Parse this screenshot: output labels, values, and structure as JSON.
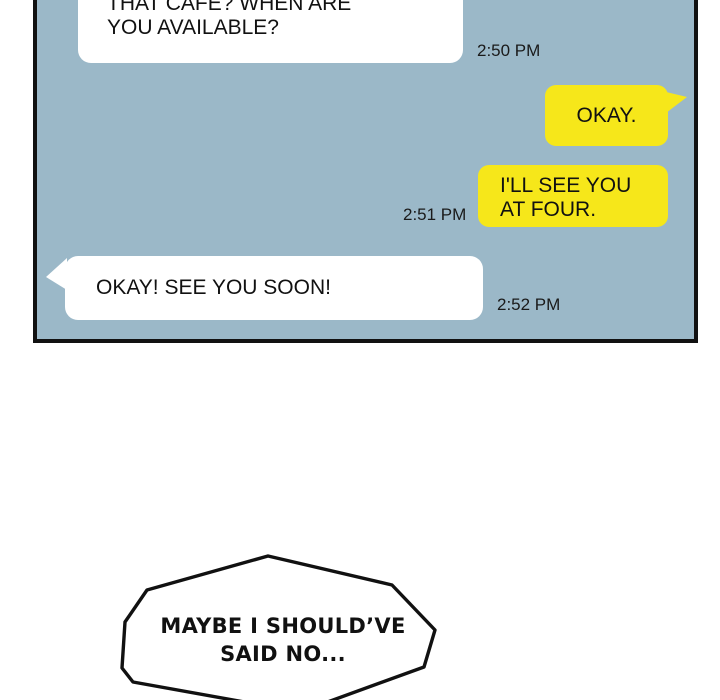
{
  "colors": {
    "page_bg": "#ffffff",
    "panel_bg": "#9bb8c8",
    "ink": "#111111",
    "bubble_received": "#ffffff",
    "bubble_sent": "#f6e71a",
    "timestamp_text": "#1a1a1a"
  },
  "chat": {
    "messages": [
      {
        "side": "left",
        "lines": [
          "THAT CAFE? WHEN ARE",
          "YOU AVAILABLE?"
        ],
        "timestamp": "2:50 PM"
      },
      {
        "side": "right",
        "lines": [
          "OKAY."
        ]
      },
      {
        "side": "right",
        "lines": [
          "I'LL SEE YOU",
          "AT FOUR."
        ],
        "timestamp": "2:51 PM"
      },
      {
        "side": "left",
        "lines": [
          "OKAY! SEE YOU SOON!"
        ],
        "timestamp": "2:52 PM"
      }
    ]
  },
  "thought_bubble": {
    "lines": [
      "MAYBE I SHOULD’VE",
      "SAID NO..."
    ]
  }
}
